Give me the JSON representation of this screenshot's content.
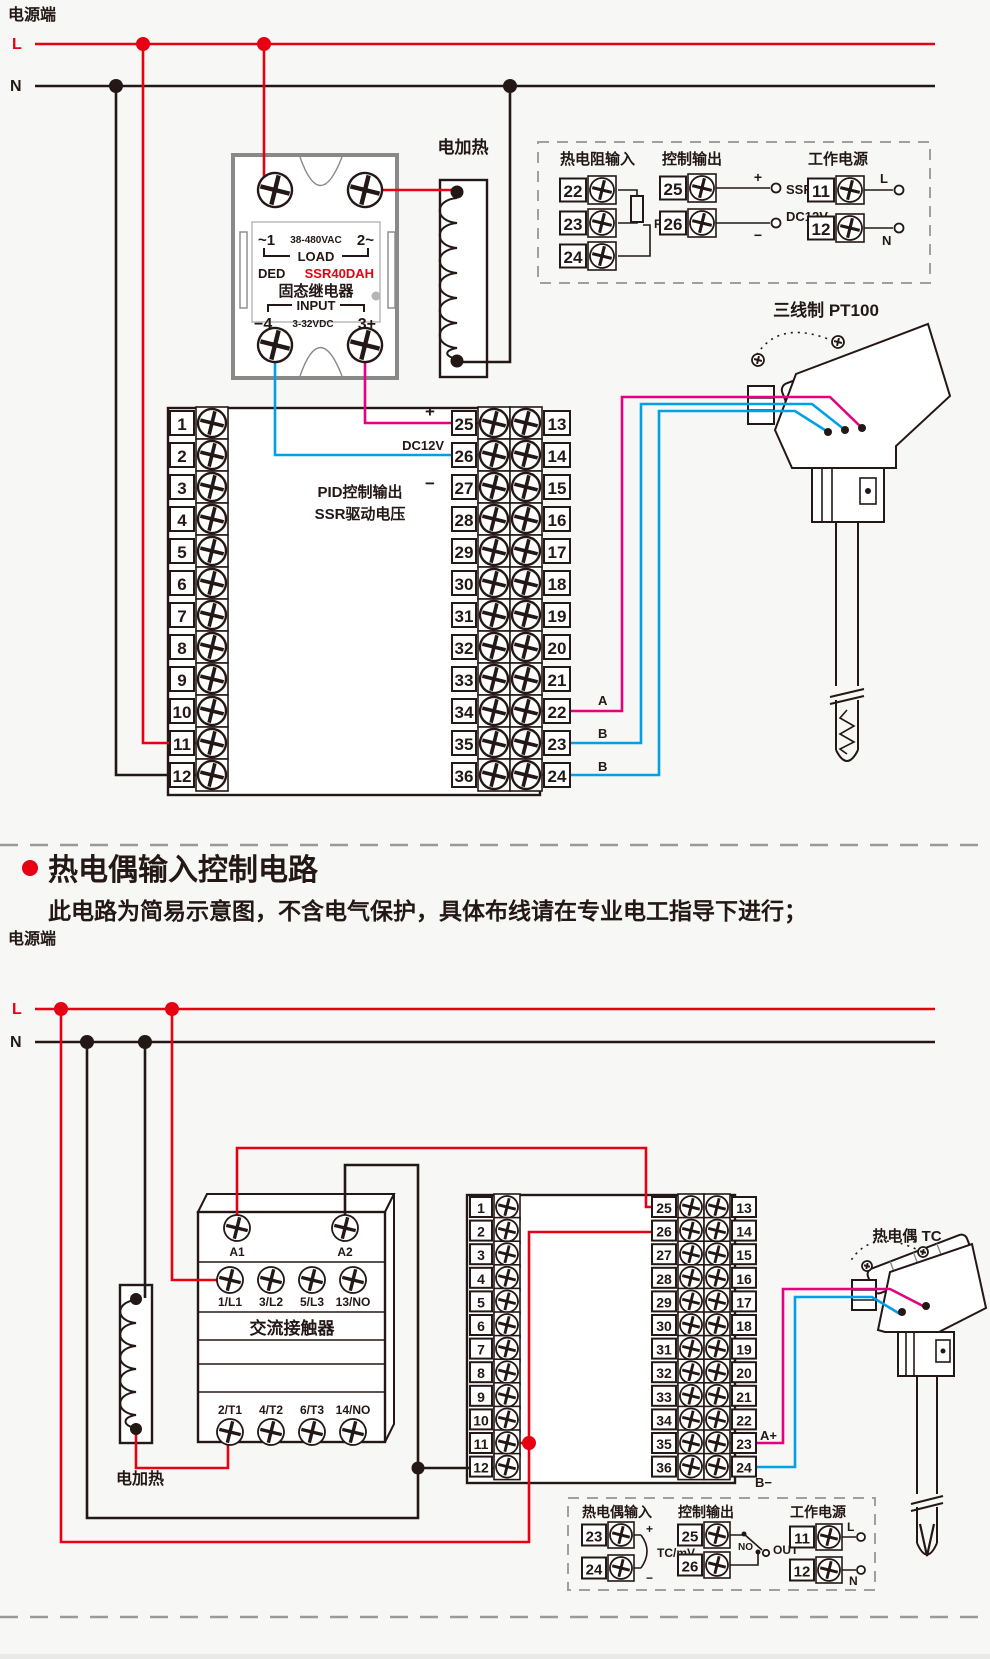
{
  "colors": {
    "line_red": "#e60012",
    "line_black": "#231815",
    "wire_pink": "#e4007f",
    "wire_blue": "#00a0e9",
    "frame_gray": "#898989",
    "dash_gray": "#9fa0a0"
  },
  "top": {
    "power": {
      "label": "电源端",
      "l": "L",
      "n": "N"
    },
    "heater": "电加热",
    "ssr": {
      "l1a": "~1",
      "l1b": "38-480VAC",
      "l1c": "2~",
      "load": "LOAD",
      "ded": "DED",
      "model": "SSR40DAH",
      "cname": "固态继电器",
      "input": "INPUT",
      "m4": "−4",
      "vdc": "3-32VDC",
      "p3": "3+"
    },
    "box": {
      "rtd": {
        "title": "热电阻输入",
        "nums": [
          "22",
          "23",
          "24"
        ],
        "label": "RTD"
      },
      "out": {
        "title": "控制输出",
        "nums": [
          "25",
          "26"
        ],
        "plus": "+",
        "minus": "−",
        "ssr": "SSR",
        "dc": "DC12V"
      },
      "pwr": {
        "title": "工作电源",
        "nums": [
          "11",
          "12"
        ],
        "l": "L",
        "n": "N"
      }
    },
    "block": {
      "left": [
        "1",
        "2",
        "3",
        "4",
        "5",
        "6",
        "7",
        "8",
        "9",
        "10",
        "11",
        "12"
      ],
      "mid": [
        "25",
        "26",
        "27",
        "28",
        "29",
        "30",
        "31",
        "32",
        "33",
        "34",
        "35",
        "36"
      ],
      "right": [
        "13",
        "14",
        "15",
        "16",
        "17",
        "18",
        "19",
        "20",
        "21",
        "22",
        "23",
        "24"
      ],
      "plus": "+",
      "dc": "DC12V",
      "minus": "−",
      "cap1": "PID控制输出",
      "cap2": "SSR驱动电压",
      "wa": "A",
      "wb1": "B",
      "wb2": "B"
    },
    "sensor_title": "三线制 PT100"
  },
  "section": {
    "title": "热电偶输入控制电路",
    "note": "此电路为简易示意图，不含电气保护，具体布线请在专业电工指导下进行；"
  },
  "bottom": {
    "power": {
      "label": "电源端",
      "l": "L",
      "n": "N"
    },
    "heater": "电加热",
    "contactor": {
      "a1": "A1",
      "a2": "A2",
      "r1": [
        "1/L1",
        "3/L2",
        "5/L3",
        "13/NO"
      ],
      "name": "交流接触器",
      "r2": [
        "2/T1",
        "4/T2",
        "6/T3",
        "14/NO"
      ]
    },
    "block": {
      "left": [
        "1",
        "2",
        "3",
        "4",
        "5",
        "6",
        "7",
        "8",
        "9",
        "10",
        "11",
        "12"
      ],
      "mid": [
        "25",
        "26",
        "27",
        "28",
        "29",
        "30",
        "31",
        "32",
        "33",
        "34",
        "35",
        "36"
      ],
      "right": [
        "13",
        "14",
        "15",
        "16",
        "17",
        "18",
        "19",
        "20",
        "21",
        "22",
        "23",
        "24"
      ],
      "aplus": "A+",
      "bminus": "B−"
    },
    "sensor_title": "热电偶 TC",
    "box": {
      "tc": {
        "title": "热电偶输入",
        "nums": [
          "23",
          "24"
        ],
        "plus": "+",
        "minus": "−",
        "label": "TC/mV"
      },
      "out": {
        "title": "控制输出",
        "nums": [
          "25",
          "26"
        ],
        "no": "NO",
        "out": "OUT"
      },
      "pwr": {
        "title": "工作电源",
        "nums": [
          "11",
          "12"
        ],
        "l": "L",
        "n": "N"
      }
    }
  }
}
